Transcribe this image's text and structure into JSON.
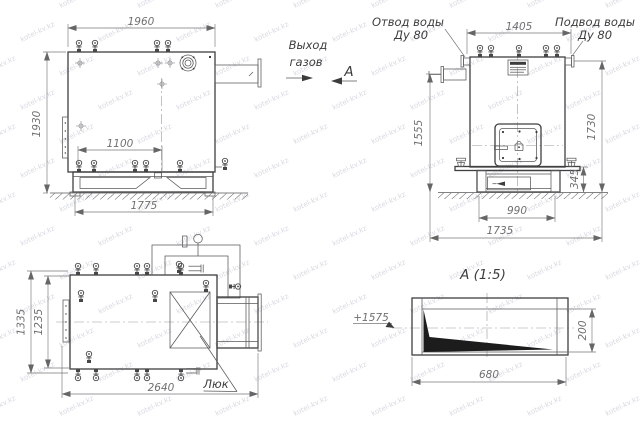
{
  "watermark": {
    "text": "kotel-kv.kz"
  },
  "colors": {
    "line": "#3f3f3f",
    "thin": "#585858",
    "dimension": "#787878",
    "text": "#3d3d3d",
    "background": "#ffffff"
  },
  "front_view": {
    "dim_width": "1960",
    "dim_height": "1930",
    "dim_valve_spacing": "1100",
    "dim_base_length": "1775"
  },
  "side_view": {
    "label_water_outlet_line1": "Отвод воды",
    "label_water_outlet_line2": "Ду 80",
    "label_water_inlet_line1": "Подвод воды",
    "label_water_inlet_line2": "Ду 80",
    "dim_top_width": "1405",
    "dim_height_left": "1555",
    "dim_height_right": "1730",
    "dim_base_height": "345",
    "dim_base_inner": "990",
    "dim_base_overall": "1735"
  },
  "plan_view": {
    "dim_width_outer": "1335",
    "dim_width_inner": "1235",
    "dim_length": "2640",
    "label_hatch": "Люк"
  },
  "section_view": {
    "title": "А (1:5)",
    "level_mark": "+1575",
    "dim_length": "680",
    "dim_height": "200"
  },
  "annotations": {
    "gas_exit_line1": "Выход",
    "gas_exit_line2": "газов",
    "section_arrow_label": "А"
  }
}
